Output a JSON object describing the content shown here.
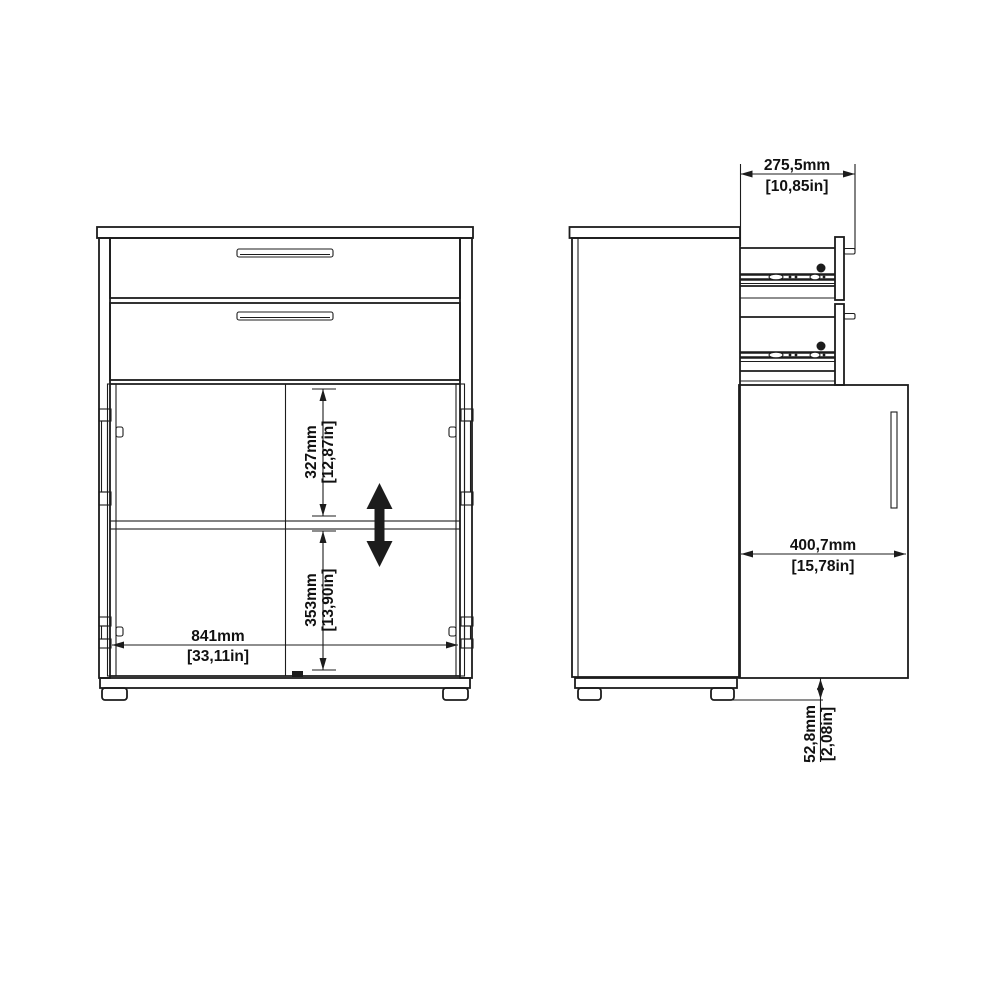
{
  "dimensions": {
    "front": {
      "upper_opening_height": {
        "mm": "327mm",
        "inches": "[12,87in]"
      },
      "lower_opening_height": {
        "mm": "353mm",
        "inches": "[13,90in]"
      },
      "interior_width": {
        "mm": "841mm",
        "inches": "[33,11in]"
      }
    },
    "side": {
      "drawer_extension": {
        "mm": "275,5mm",
        "inches": "[10,85in]"
      },
      "door_width": {
        "mm": "400,7mm",
        "inches": "[15,78in]"
      },
      "plinth_height": {
        "mm": "52,8mm",
        "inches": "[2,08in]"
      }
    }
  },
  "colors": {
    "line": "#1c1c1c",
    "background": "#ffffff",
    "arrow_fill": "#000000"
  }
}
